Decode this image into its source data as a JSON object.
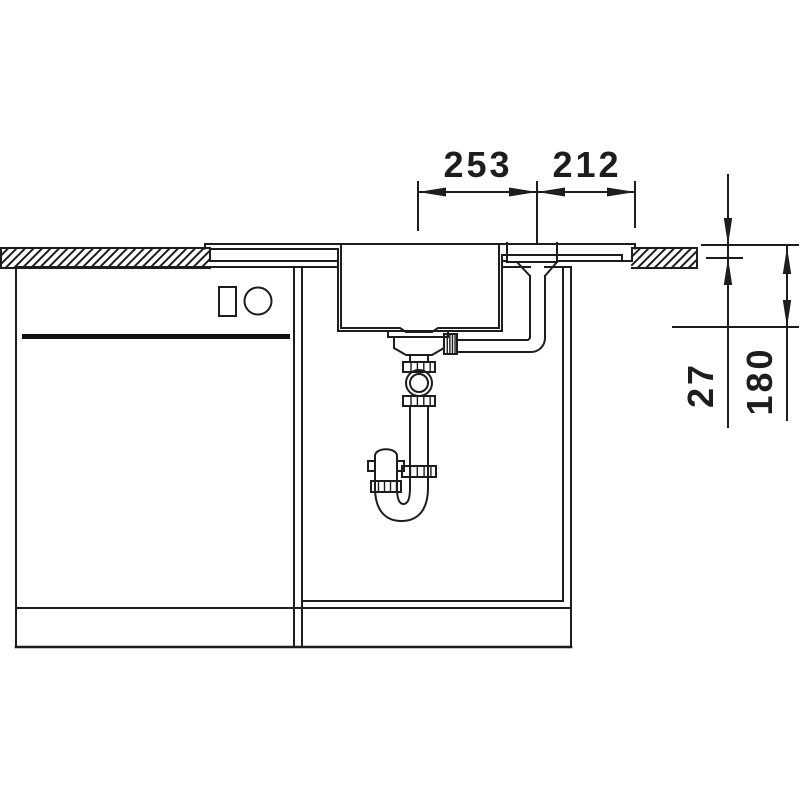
{
  "drawing": {
    "dimensions_mm": {
      "d253": {
        "label": "253"
      },
      "d212": {
        "label": "212"
      },
      "d27": {
        "label": "27"
      },
      "d180": {
        "label": "180"
      }
    },
    "colors": {
      "line": "#1d1d1b",
      "background": "#ffffff",
      "appliance_band": "#111111"
    }
  }
}
